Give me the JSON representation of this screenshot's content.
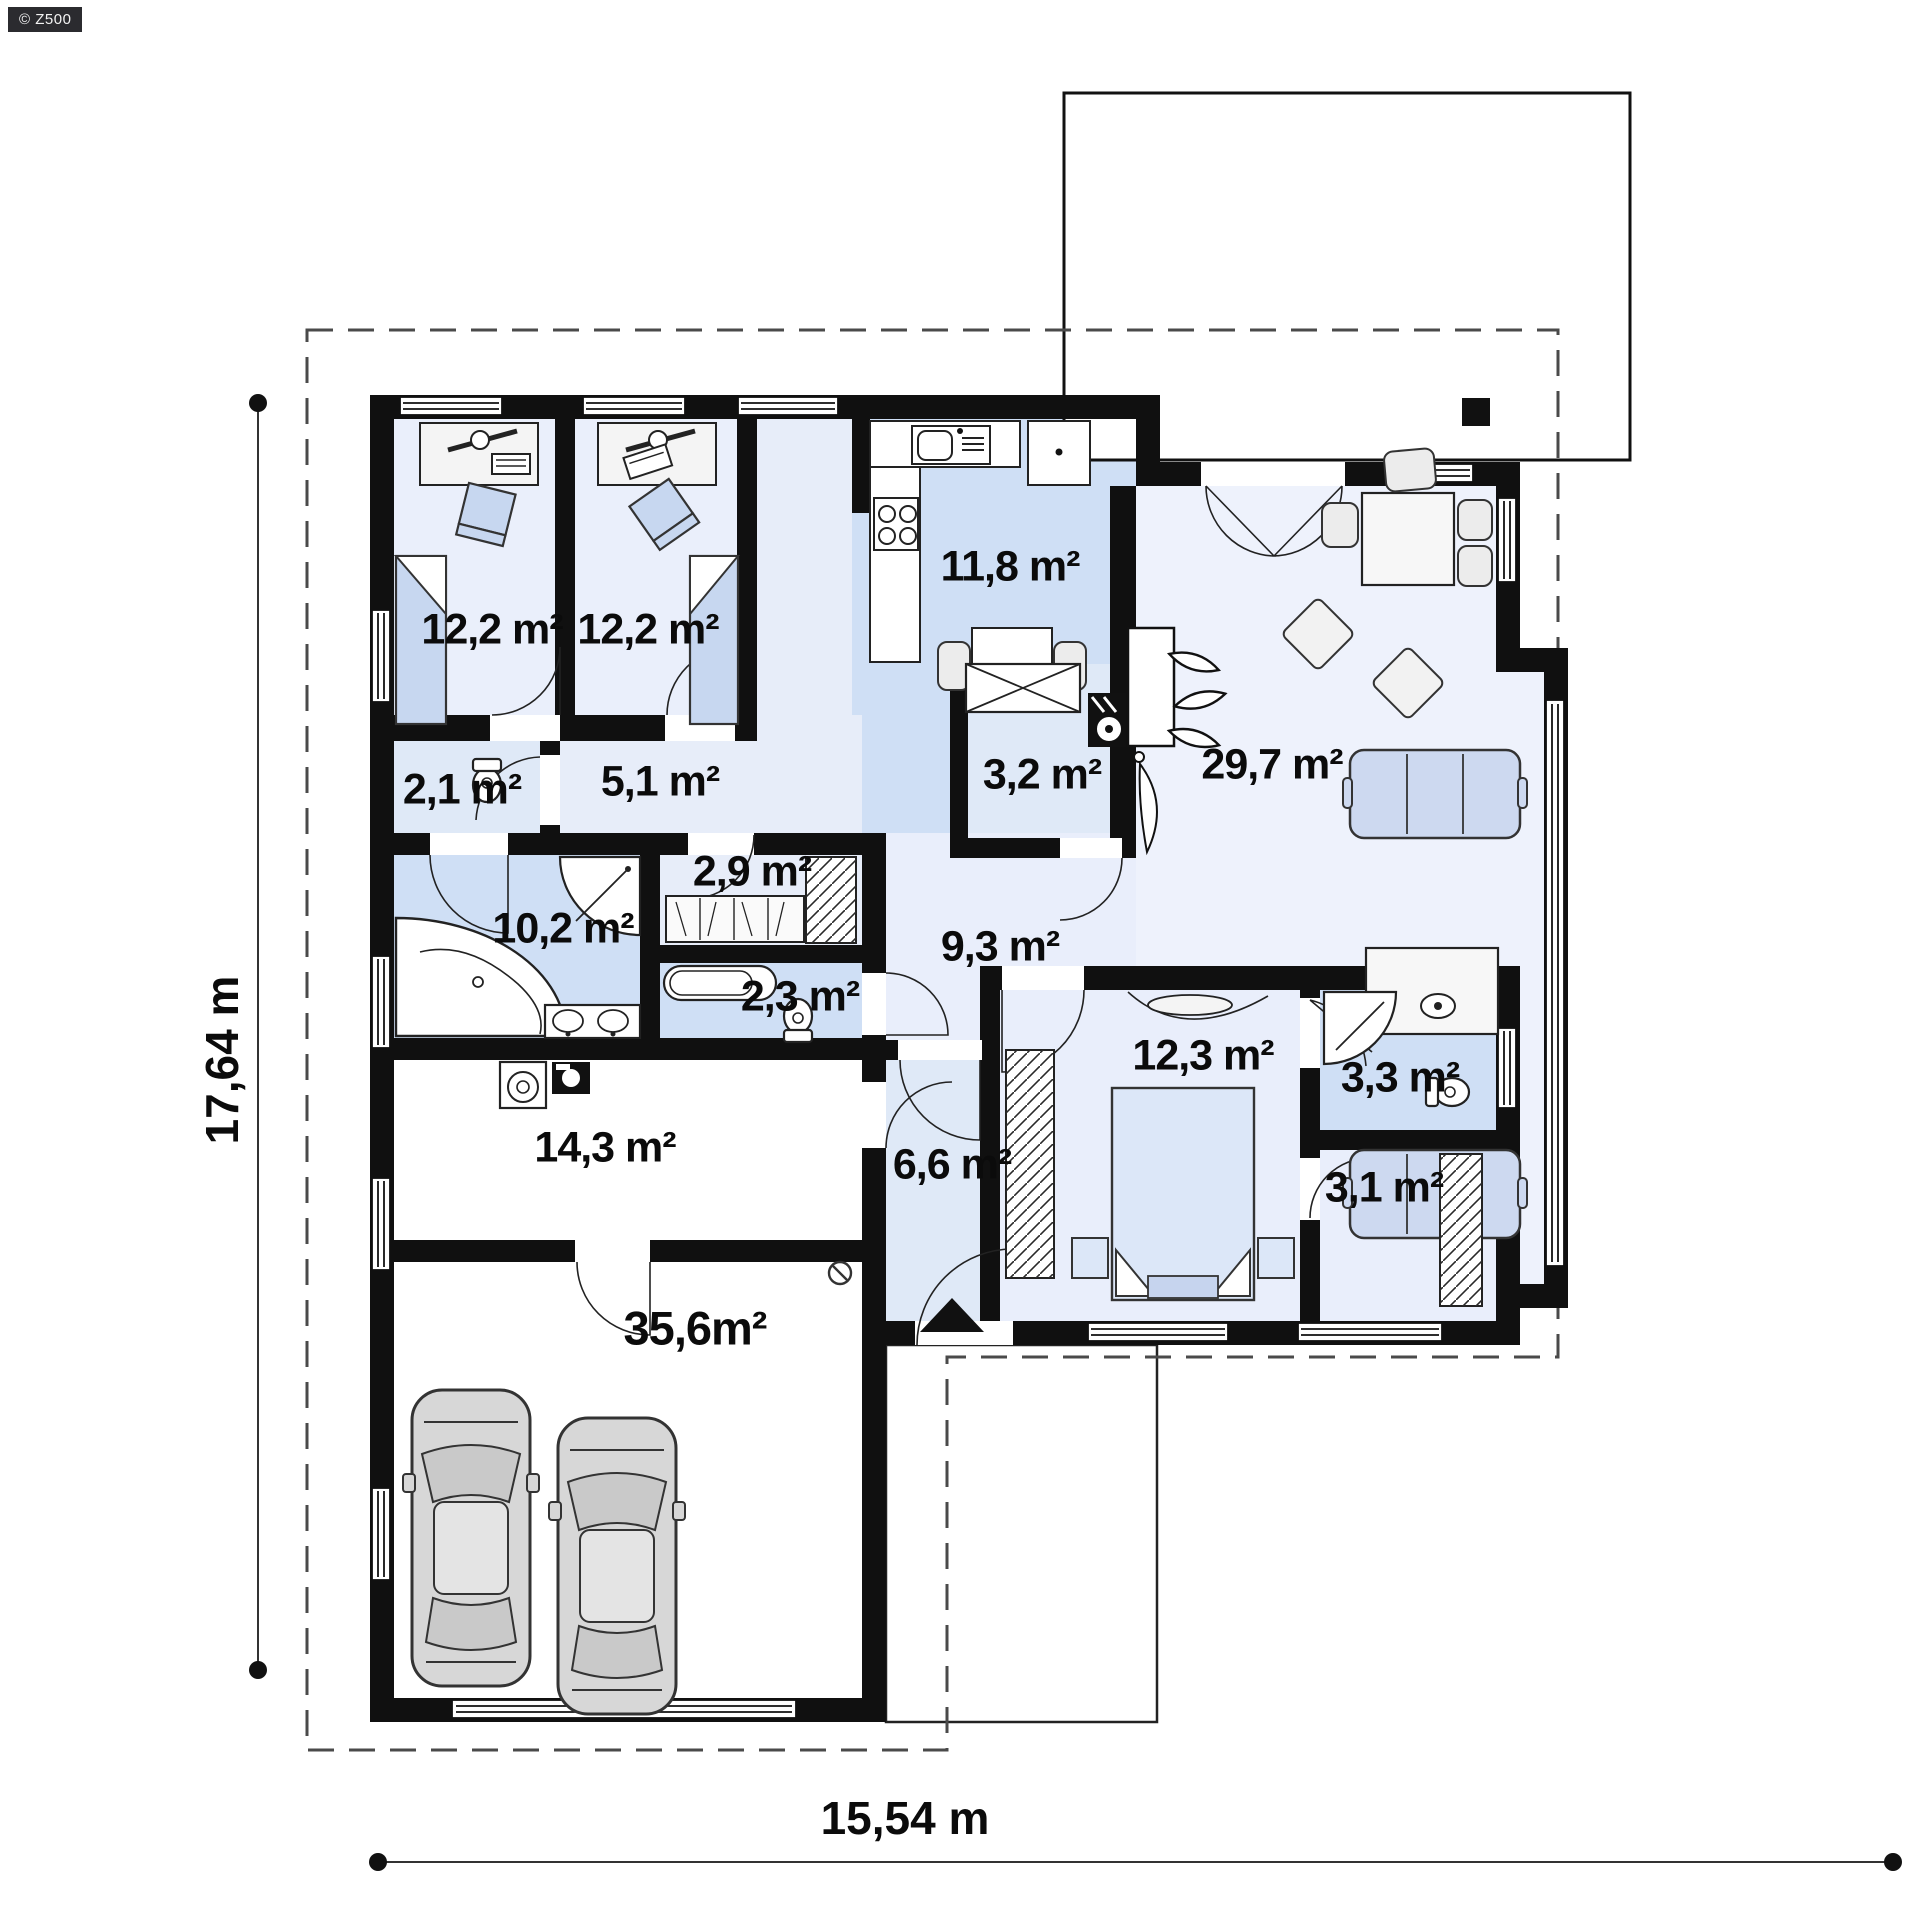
{
  "watermark": {
    "label": "© Z500"
  },
  "plan": {
    "rooms": [
      {
        "id": "bedroom-1",
        "area": "12,2 m²"
      },
      {
        "id": "bedroom-2",
        "area": "12,2 m²"
      },
      {
        "id": "kitchen",
        "area": "11,8 m²"
      },
      {
        "id": "wc-small",
        "area": "2,1 m²"
      },
      {
        "id": "hallway",
        "area": "5,1 m²"
      },
      {
        "id": "pantry",
        "area": "3,2 m²"
      },
      {
        "id": "living-room",
        "area": "29,7 m²"
      },
      {
        "id": "wardrobe-hall",
        "area": "2,9 m²"
      },
      {
        "id": "bathroom-main",
        "area": "10,2 m²"
      },
      {
        "id": "bathroom-small",
        "area": "2,3 m²"
      },
      {
        "id": "hall-central",
        "area": "9,3 m²"
      },
      {
        "id": "bedroom-3",
        "area": "12,3 m²"
      },
      {
        "id": "bathroom-en-suite",
        "area": "3,3 m²"
      },
      {
        "id": "wardrobe-bedroom",
        "area": "3,1 m²"
      },
      {
        "id": "utility-room",
        "area": "14,3 m²"
      },
      {
        "id": "entrance-hall",
        "area": "6,6 m²"
      },
      {
        "id": "garage",
        "area": "35,6m²"
      }
    ],
    "dimensions": {
      "total_height": "17,64 m",
      "total_width": "15,54 m"
    },
    "colors": {
      "wall": "#101010",
      "floor_light": "#eaeffb",
      "floor_medium": "#cfdff5",
      "furniture_blue": "#c7d7f0",
      "furniture_gray": "#ececec"
    }
  }
}
